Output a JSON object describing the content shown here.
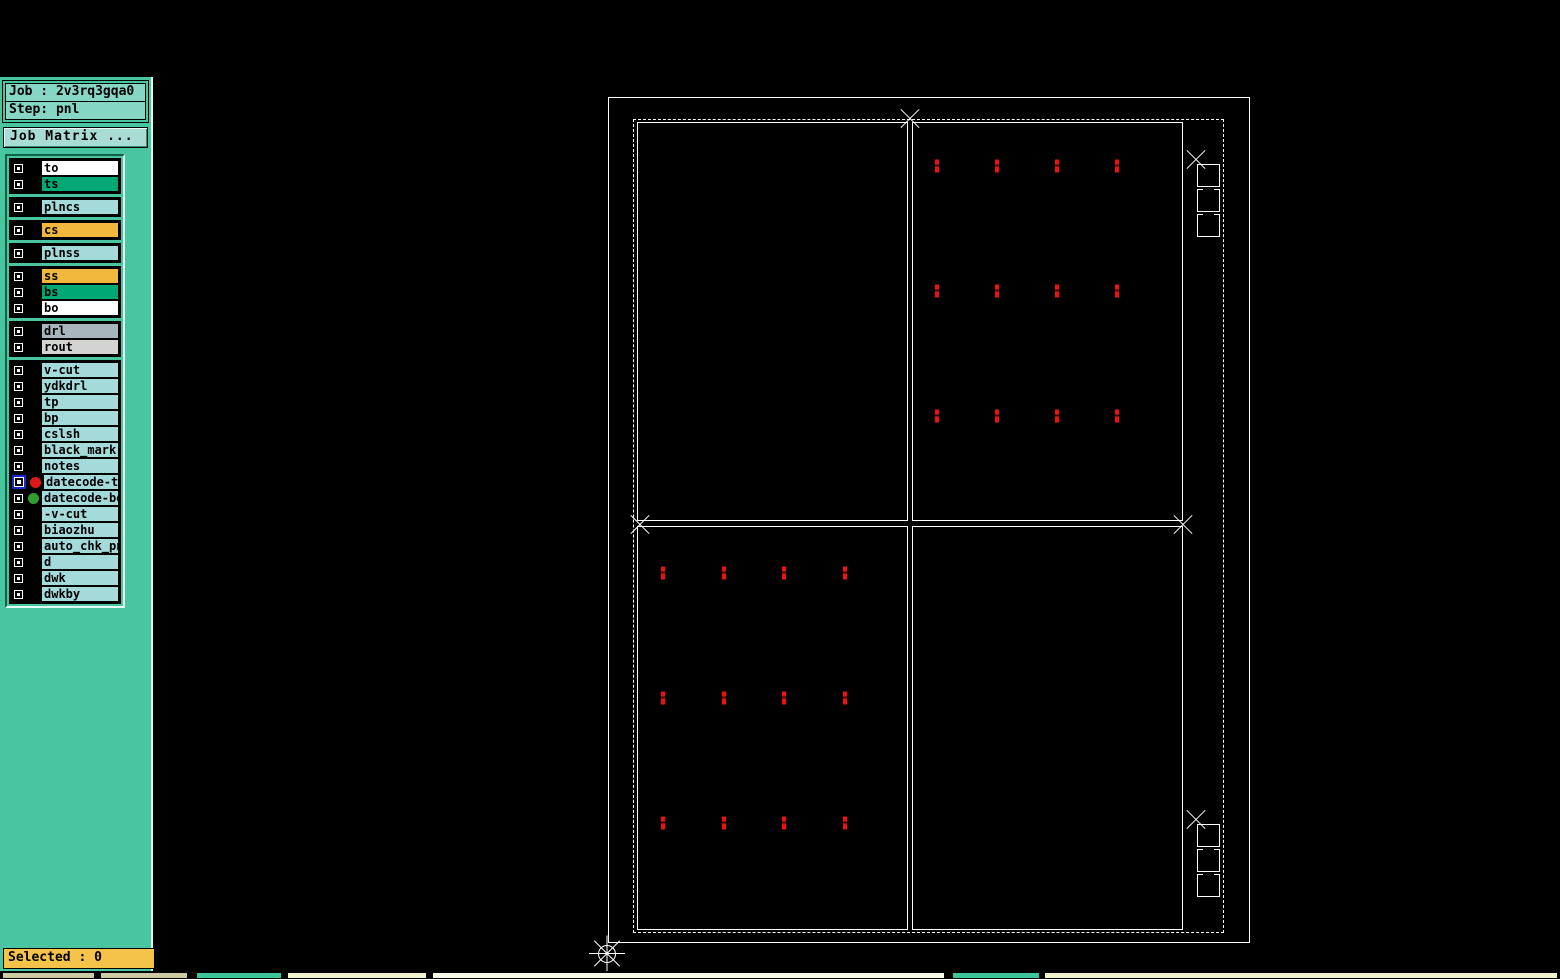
{
  "window": {
    "title": "Graphic Editor 9.07b2 (00@HY-HYCAM-PC148 - Windows, pid:1236)"
  },
  "menu": {
    "items": [
      {
        "label": "File",
        "mnemonic": "F"
      },
      {
        "label": "Edit",
        "mnemonic": "E"
      },
      {
        "label": "Actions",
        "mnemonic": "A"
      },
      {
        "label": "Options",
        "mnemonic": ""
      },
      {
        "label": "Analysis",
        "mnemonic": ""
      },
      {
        "label": "DFM",
        "mnemonic": ""
      },
      {
        "label": "Step",
        "mnemonic": "S"
      },
      {
        "label": "Rout",
        "mnemonic": "R"
      },
      {
        "label": "Windows",
        "mnemonic": "W"
      }
    ],
    "help": "Help",
    "logo_text": "Fr"
  },
  "sidebar": {
    "job_label": "Job : 2v3rq3gqa0",
    "step_label": "Step: pnl",
    "job_matrix_button": "Job Matrix ...",
    "selected_label": "Selected : 0",
    "layer_groups": [
      {
        "layers": [
          {
            "name": "to",
            "color": "#ffffff"
          },
          {
            "name": "ts",
            "color": "#00a875"
          }
        ]
      },
      {
        "layers": [
          {
            "name": "plncs",
            "color": "#a4dada"
          }
        ]
      },
      {
        "layers": [
          {
            "name": "cs",
            "color": "#f2b83e"
          }
        ]
      },
      {
        "layers": [
          {
            "name": "plnss",
            "color": "#a4dada"
          }
        ]
      },
      {
        "layers": [
          {
            "name": "ss",
            "color": "#f2b83e"
          },
          {
            "name": "bs",
            "color": "#00a875"
          },
          {
            "name": "bo",
            "color": "#ffffff"
          }
        ]
      },
      {
        "layers": [
          {
            "name": "drl",
            "color": "#a7b5bd"
          },
          {
            "name": "rout",
            "color": "#d3d3d3"
          }
        ]
      },
      {
        "layers": [
          {
            "name": "v-cut",
            "color": "#a4dada"
          },
          {
            "name": "ydkdrl",
            "color": "#a4dada"
          },
          {
            "name": "tp",
            "color": "#a4dada"
          },
          {
            "name": "bp",
            "color": "#a4dada"
          },
          {
            "name": "cslsh",
            "color": "#a4dada"
          },
          {
            "name": "black_mark",
            "color": "#a4dada"
          },
          {
            "name": "notes",
            "color": "#a4dada"
          },
          {
            "name": "datecode-top",
            "color": "#a4dada",
            "dot": "#e01818",
            "active": true
          },
          {
            "name": "datecode-bo",
            "color": "#a4dada",
            "dot": "#2f9e2f"
          },
          {
            "name": "-v-cut",
            "color": "#a4dada"
          },
          {
            "name": "biaozhu",
            "color": "#a4dada"
          },
          {
            "name": "auto_chk_pnl",
            "color": "#a4dada"
          },
          {
            "name": "d",
            "color": "#a4dada"
          },
          {
            "name": "dwk",
            "color": "#a4dada"
          },
          {
            "name": "dwkby",
            "color": "#a4dada"
          }
        ]
      }
    ]
  },
  "canvas": {
    "outer_rect": {
      "x": 608,
      "y": 97,
      "w": 642,
      "h": 846
    },
    "dashed_rect": {
      "x": 633,
      "y": 119,
      "w": 591,
      "h": 814
    },
    "panels": [
      {
        "x": 637,
        "y": 122,
        "w": 271,
        "h": 399
      },
      {
        "x": 912,
        "y": 122,
        "w": 271,
        "h": 399
      },
      {
        "x": 637,
        "y": 526,
        "w": 271,
        "h": 404
      },
      {
        "x": 912,
        "y": 526,
        "w": 271,
        "h": 404
      }
    ],
    "fiducial_grids": [
      {
        "cols": [
          937,
          997,
          1057,
          1117
        ],
        "rows": [
          166,
          291,
          416
        ]
      },
      {
        "cols": [
          663,
          724,
          784,
          845
        ],
        "rows": [
          573,
          698,
          823
        ]
      }
    ],
    "star_markers": [
      {
        "x": 910,
        "y": 119
      },
      {
        "x": 640,
        "y": 525
      },
      {
        "x": 1183,
        "y": 525
      },
      {
        "x": 1196,
        "y": 160
      },
      {
        "x": 1196,
        "y": 820
      }
    ],
    "origin_marker": {
      "x": 607,
      "y": 954
    },
    "coupon_stacks": [
      {
        "x": 1197,
        "y": 164
      },
      {
        "x": 1197,
        "y": 824
      }
    ],
    "mark_color": "#f01010"
  },
  "bottom_strip": [
    {
      "x": 2,
      "w": 93,
      "color": "#ccc9a3"
    },
    {
      "x": 100,
      "w": 88,
      "color": "#ccc9a3"
    },
    {
      "x": 196,
      "w": 86,
      "color": "#3cc49c"
    },
    {
      "x": 287,
      "w": 140,
      "color": "#f2f2cc"
    },
    {
      "x": 432,
      "w": 513,
      "color": "#fafae8"
    },
    {
      "x": 952,
      "w": 88,
      "color": "#3cc49c"
    },
    {
      "x": 1044,
      "w": 514,
      "color": "#f2f2cc"
    }
  ],
  "colors": {
    "menu_bg": "#b0dcdc",
    "sidebar_bg": "#49c6a0",
    "field_bg": "#86d6c6",
    "selected_bg": "#f5c349",
    "fiducial_red": "#f01010",
    "active_dot_red": "#e01818",
    "dot_green": "#2f9e2f",
    "logo_blue": "#1a2aa2",
    "logo_red": "#e01818"
  }
}
